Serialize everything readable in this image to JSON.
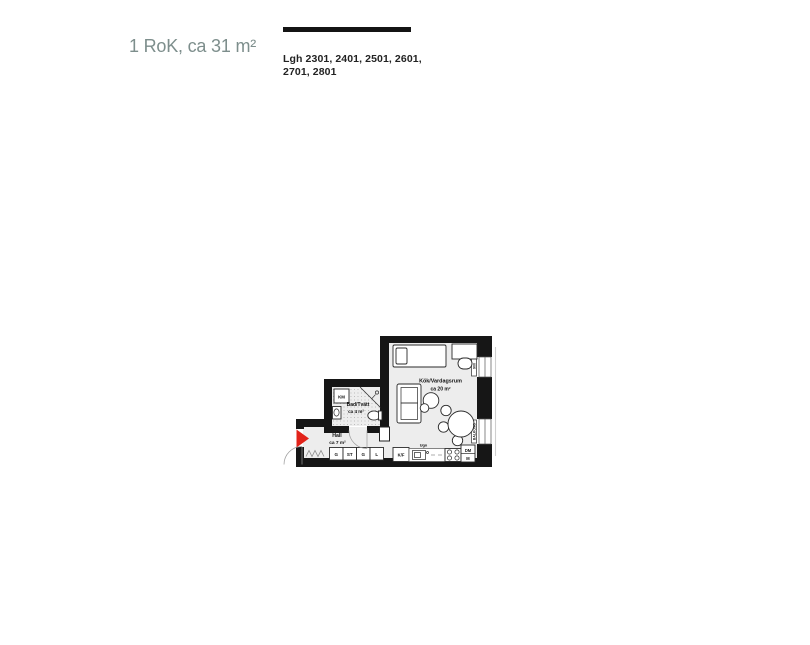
{
  "header": {
    "title": "1 RoK, ca 31 m²",
    "apartments": [
      "Lgh 2301, 2401, 2501, 2601,",
      "2701, 2801"
    ]
  },
  "plan": {
    "livingroom": {
      "name": "Kök/Vardagsrum",
      "area": "ca 20 m²"
    },
    "bathroom": {
      "name": "Bad/Tvätt",
      "area": "ca 4 m²"
    },
    "hall": {
      "name": "Hall",
      "area": "ca 7 m²"
    },
    "appliances": {
      "washer": "KM",
      "fridge_freezer": "K/F",
      "oven": "Ugn",
      "dishwasher": "DM",
      "micro": "M"
    },
    "storage": {
      "g1": "G",
      "st": "ST",
      "g2": "G",
      "l": "L"
    },
    "wall_labels": {
      "window_top": "900",
      "balcony": "BALKONG"
    },
    "colors": {
      "wall": "#161616",
      "floor": "#ededed",
      "entry_arrow": "#e2231a",
      "title_text": "#7d8e8c"
    }
  }
}
